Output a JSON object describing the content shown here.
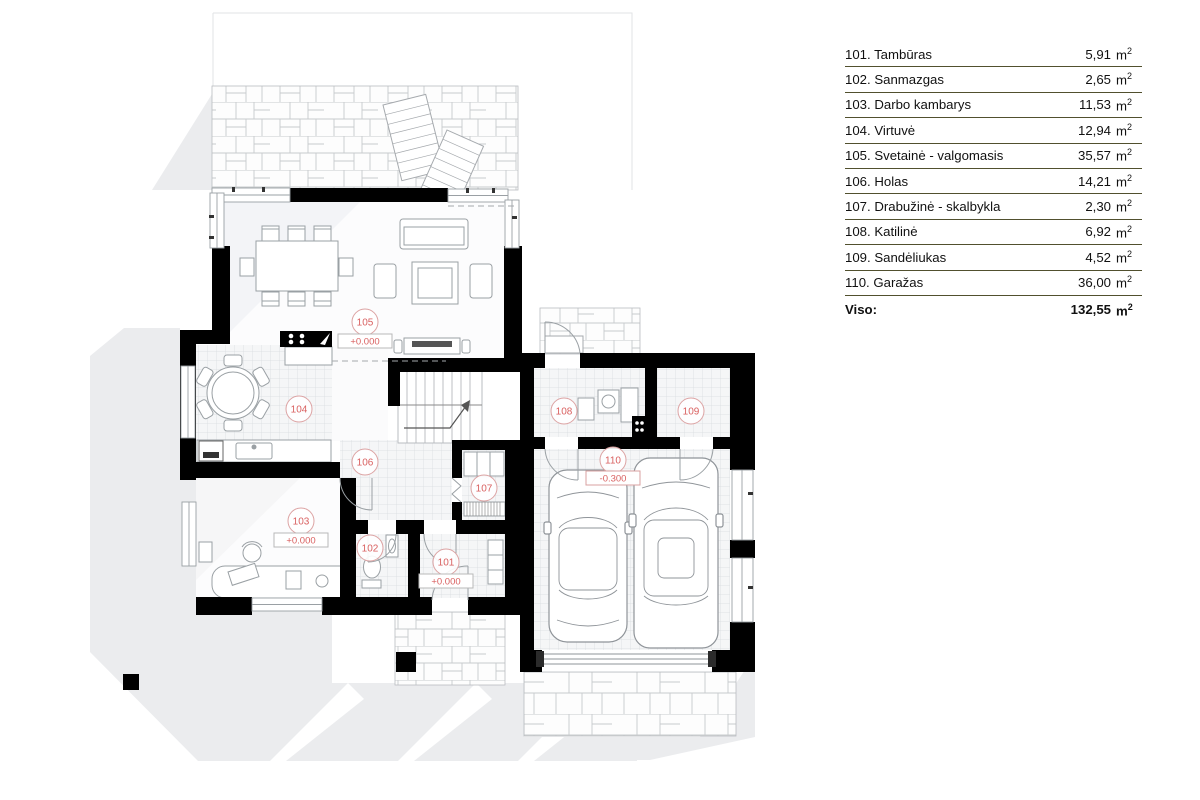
{
  "legend": {
    "rows": [
      {
        "name": "101. Tambūras",
        "area": "5,91"
      },
      {
        "name": "102. Sanmazgas",
        "area": "2,65"
      },
      {
        "name": "103. Darbo kambarys",
        "area": "11,53"
      },
      {
        "name": "104. Virtuvė",
        "area": "12,94"
      },
      {
        "name": "105. Svetainė - valgomasis",
        "area": "35,57"
      },
      {
        "name": "106. Holas",
        "area": "14,21"
      },
      {
        "name": "107. Drabužinė - skalbykla",
        "area": "2,30"
      },
      {
        "name": "108. Katilinė",
        "area": "6,92"
      },
      {
        "name": "109. Sandėliukas",
        "area": "4,52"
      },
      {
        "name": "110. Garažas",
        "area": "36,00"
      }
    ],
    "unit": "m",
    "unit_sup": "2",
    "total_label": "Viso:",
    "total_area": "132,55"
  },
  "plan": {
    "room_labels": [
      {
        "number": "101",
        "elevation": "+0.000"
      },
      {
        "number": "102"
      },
      {
        "number": "103",
        "elevation": "+0.000"
      },
      {
        "number": "104"
      },
      {
        "number": "105",
        "elevation": "+0.000"
      },
      {
        "number": "106"
      },
      {
        "number": "107"
      },
      {
        "number": "108"
      },
      {
        "number": "109"
      },
      {
        "number": "110",
        "elevation": "-0.300"
      }
    ]
  },
  "colors": {
    "wall": "#000000",
    "label_red": "#d96060",
    "table_rule": "#51502e",
    "shadow_gray": "#ebecee",
    "tile_line": "#d9dce0"
  }
}
